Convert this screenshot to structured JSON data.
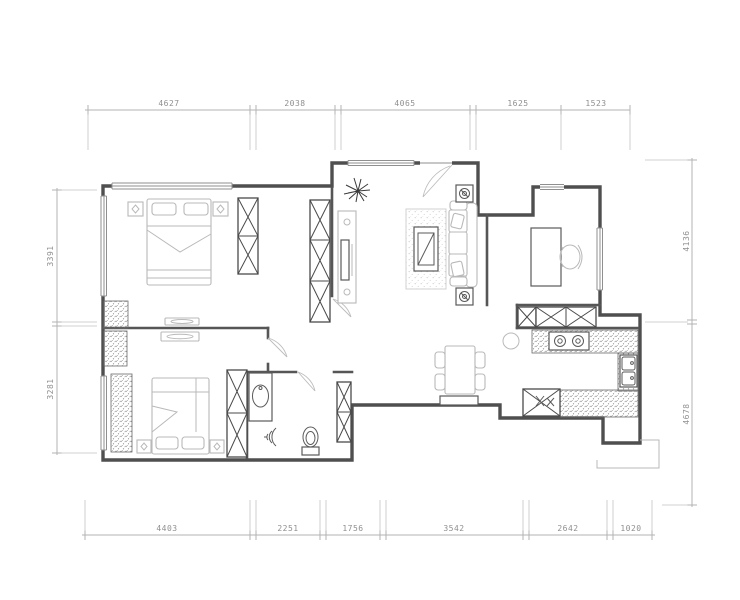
{
  "drawing": {
    "colors": {
      "background": "#ffffff",
      "walls": "#4f4f4f",
      "fixtures": "#5a5a5a",
      "furniture": "#b9b9b9",
      "hatch_dots": "#8a8a8a",
      "dimension_lines": "#b3b3b3",
      "dimension_text": "#8f8f8f"
    },
    "dims": {
      "top": [
        "4627",
        "2038",
        "4065",
        "1625",
        "1523"
      ],
      "bottom": [
        "4403",
        "2251",
        "1756",
        "3542",
        "2642",
        "1020"
      ],
      "left": [
        "3391",
        "3281"
      ],
      "right": [
        "4136",
        "4678"
      ]
    }
  }
}
